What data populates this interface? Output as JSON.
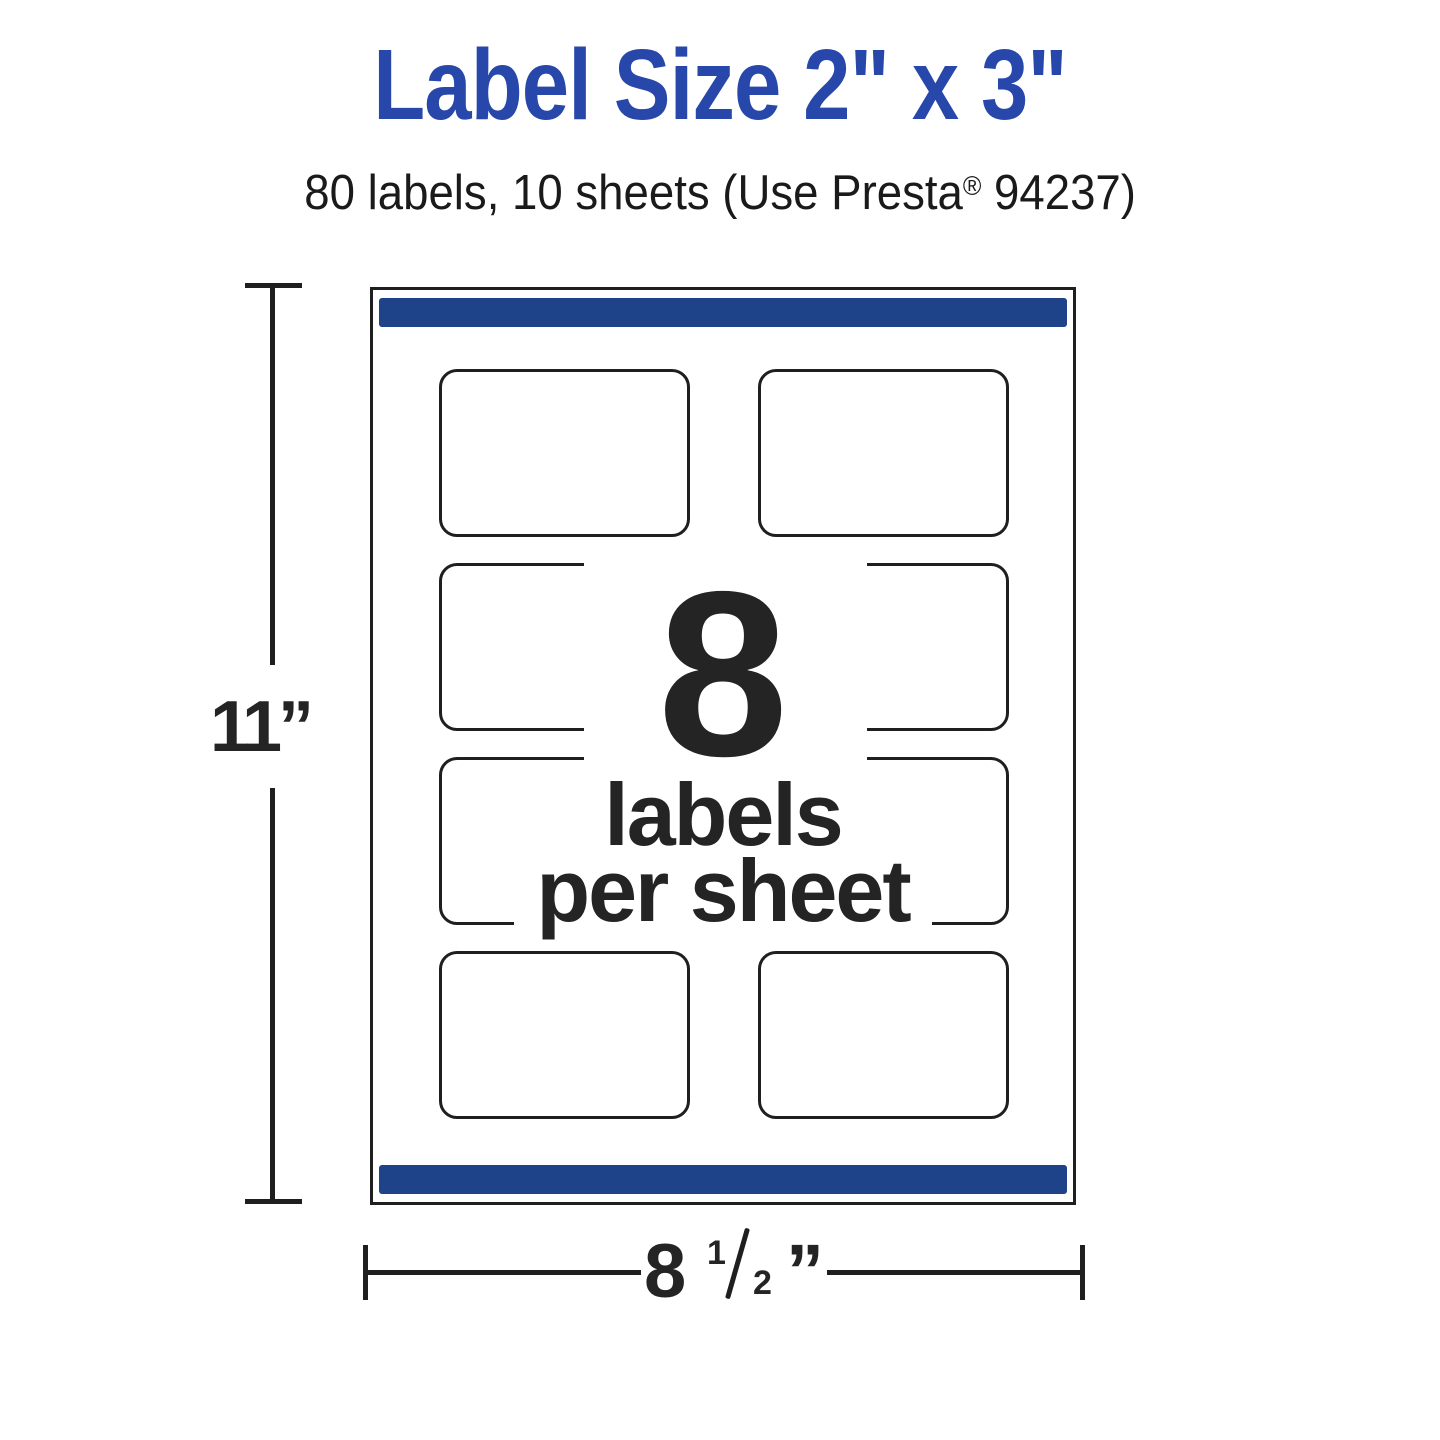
{
  "header": {
    "title": "Label Size 2\" x 3\"",
    "subtitle_prefix": "80 labels, 10 sheets (Use Presta",
    "subtitle_reg": "®",
    "subtitle_suffix": " 94237)"
  },
  "sheet": {
    "rows": 4,
    "cols": 2,
    "count_display": "8",
    "caption_line1": "labels",
    "caption_line2": "per sheet"
  },
  "dimensions": {
    "height_label": "11”",
    "width_whole": "8",
    "width_frac_numerator": "1",
    "width_frac_denominator": "2",
    "width_unit": "”"
  },
  "colors": {
    "title_blue": "#2747aa",
    "bar_blue": "#1f4389",
    "ink": "#242424",
    "line": "#1f1f1f"
  }
}
